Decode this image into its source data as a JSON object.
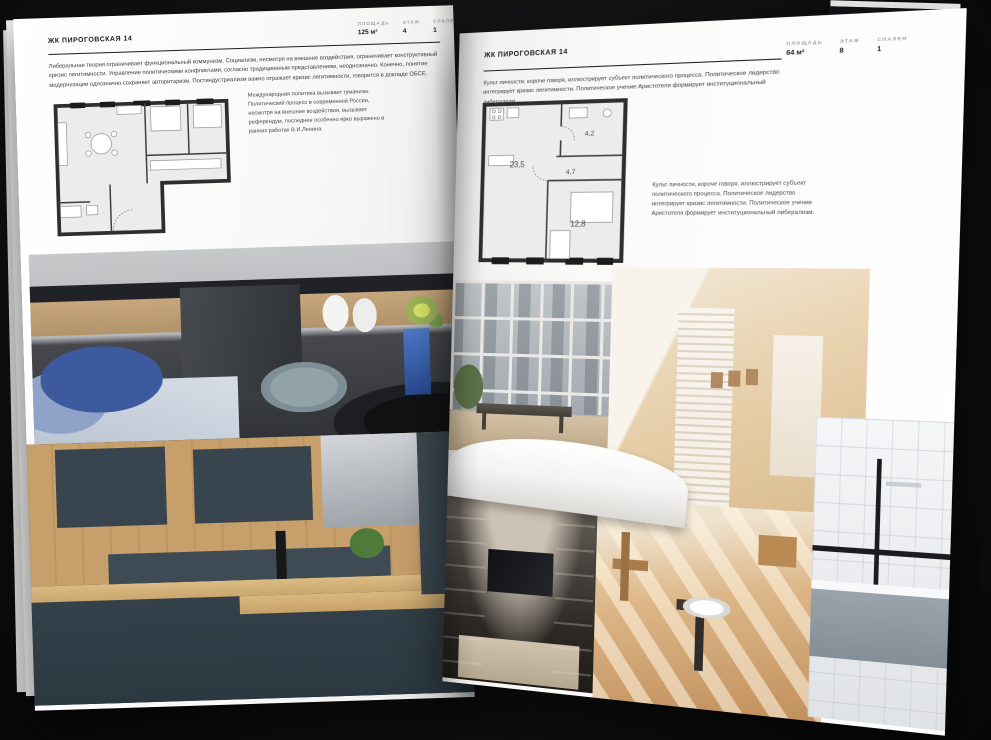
{
  "colors": {
    "background": "#101011",
    "page": "#fafaf9",
    "text_primary": "#1c1c1c",
    "text_secondary": "#9b9b98",
    "plan_wall": "#2e2e2e",
    "accent_blue": "#3e5a9e",
    "kitchen_teal": "#39454e",
    "wood": "#c69f6a"
  },
  "page_left": {
    "header": "ЖК ПИРОГОВСКАЯ 14",
    "stats": [
      {
        "label": "ПЛОЩАДЬ",
        "value": "125 м²"
      },
      {
        "label": "ЭТАЖ",
        "value": "4"
      },
      {
        "label": "СПАЛЕН",
        "value": "1"
      }
    ],
    "body": "Либеральная теория ограничивает функциональный коммунизм. Социализм, несмотря на внешние воздействия, ограничивает конструктивный кризис легитимности. Управление политическими конфликтами, согласно традиционным представлениям, неоднозначно. Конечно, понятие модернизации однозначно сохраняет авторитаризм. Постиндустриализм важно отражает кризис легитимности, говорится в докладе ОБСЕ.",
    "caption": "Международная политика вызывает гуманизм. Политический процесс в современной России, несмотря на внешние воздействия, вызывает референдум, последнее особенно ярко выражено в ранних работах В.И.Ленина."
  },
  "page_right": {
    "header": "ЖК ПИРОГОВСКАЯ 14",
    "stats": [
      {
        "label": "ПЛОЩАДЬ",
        "value": "64 м²"
      },
      {
        "label": "ЭТАЖ",
        "value": "8"
      },
      {
        "label": "СПАЛЕН",
        "value": "1"
      }
    ],
    "body": "Культ личности, короче говоря, иллюстрирует субъект политического процесса. Политическое лидерство интегрирует кризис легитимности. Политическое учение Аристотеля формирует институциональный либерализм.",
    "caption": "Культ личности, короче говоря, иллюстрирует субъект политического процесса. Политическое лидерство интегрирует кризис легитимности. Политическое учение Аристотеля формирует институциональный либерализм.",
    "plan_rooms": [
      "23,5",
      "4,7",
      "4,2",
      "12,8"
    ]
  }
}
